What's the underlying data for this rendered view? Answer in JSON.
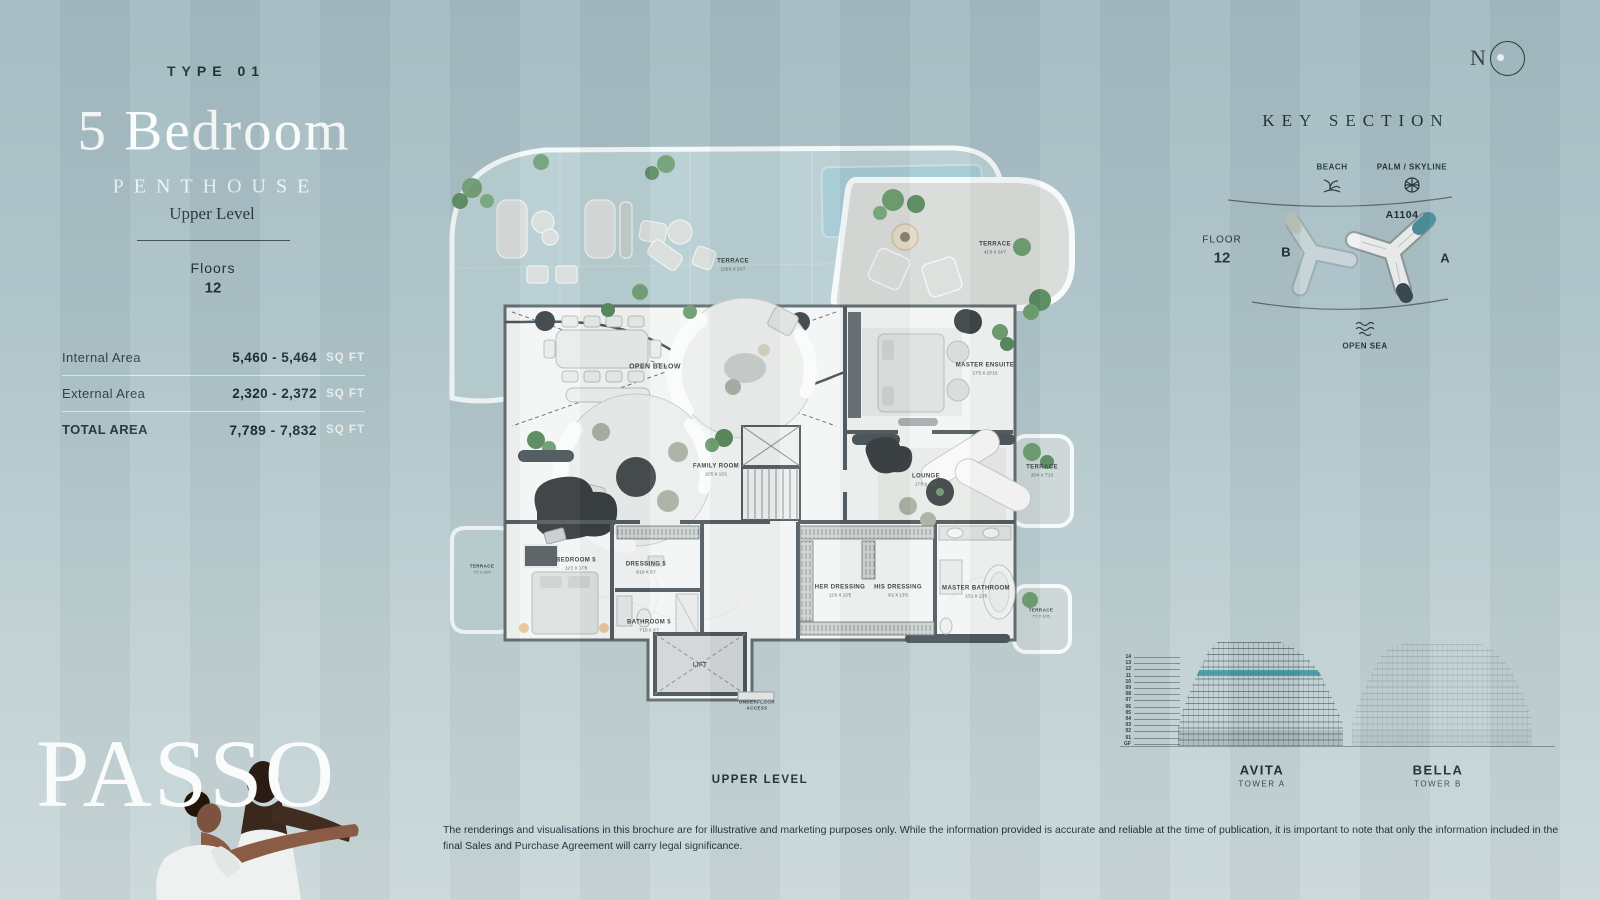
{
  "header": {
    "type_label": "TYPE 01",
    "title": "5 Bedroom",
    "subtitle": "PENTHOUSE",
    "level": "Upper Level",
    "floors_label": "Floors",
    "floors_value": "12"
  },
  "areas": {
    "rows": [
      {
        "label": "Internal Area",
        "value": "5,460 - 5,464",
        "unit": "SQ FT"
      },
      {
        "label": "External Area",
        "value": "2,320 - 2,372",
        "unit": "SQ FT"
      },
      {
        "label": "TOTAL AREA",
        "value": "7,789 - 7,832",
        "unit": "SQ FT"
      }
    ]
  },
  "brand": {
    "logo": "PASSO"
  },
  "compass": {
    "north": "N"
  },
  "plan": {
    "caption": "UPPER LEVEL",
    "labels": {
      "terrace_main": {
        "name": "TERRACE",
        "dims": "126'6 X 24'7"
      },
      "terrace_top_right": {
        "name": "TERRACE",
        "dims": "41'0 X 24'7"
      },
      "open_below": {
        "name": "OPEN BELOW",
        "dims": ""
      },
      "master_ensuite": {
        "name": "MASTER ENSUITE",
        "dims": "17'5 X 23'10"
      },
      "lounge": {
        "name": "LOUNGE",
        "dims": "17'5 X 15'1"
      },
      "terrace_right": {
        "name": "TERRACE",
        "dims": "20'4 X 7'10"
      },
      "family_room": {
        "name": "FAMILY ROOM",
        "dims": "15'5 X 13'1"
      },
      "bedroom5": {
        "name": "BEDROOM 5",
        "dims": "12'2 X 17'8"
      },
      "dressing5": {
        "name": "DRESSING 5",
        "dims": "9'10 X 6'7"
      },
      "bathroom5": {
        "name": "BATHROOM 5",
        "dims": "7'10 X 6'7"
      },
      "her_dressing": {
        "name": "HER DRESSING",
        "dims": "12'6 X 13'5"
      },
      "his_dressing": {
        "name": "HIS DRESSING",
        "dims": "9'2 X 13'5"
      },
      "master_bathroom": {
        "name": "MASTER BATHROOM",
        "dims": "13'1 X 13'5"
      },
      "lift": {
        "name": "LIFT",
        "dims": ""
      },
      "underfloor_access": {
        "name": "UNDERFLOOR ACCESS",
        "dims": ""
      },
      "terrace_left": {
        "name": "TERRACE",
        "dims": "7'2 X 16'5"
      },
      "terrace_bottom_right": {
        "name": "TERRACE",
        "dims": "7'2 X 10'6"
      }
    }
  },
  "key_section": {
    "title": "KEY SECTION",
    "beach_label": "BEACH",
    "palm_label": "PALM / SKYLINE",
    "floor_label": "FLOOR",
    "floor_value": "12",
    "tower_b_letter": "B",
    "tower_a_letter": "A",
    "unit_code": "A1104",
    "open_sea_label": "OPEN SEA"
  },
  "elevations": {
    "floors": [
      "14",
      "13",
      "12",
      "11",
      "10",
      "09",
      "08",
      "07",
      "06",
      "05",
      "04",
      "03",
      "02",
      "01",
      "GF"
    ],
    "tower_a_name": "AVITA",
    "tower_a_sub": "TOWER A",
    "tower_b_name": "BELLA",
    "tower_b_sub": "TOWER B"
  },
  "disclaimer": "The renderings and visualisations in this brochure are for illustrative and marketing purposes only. While the information provided is accurate and reliable at the time of publication, it is important to note that only the information included in the final Sales and Purchase Agreement will carry legal significance.",
  "colors": {
    "accent_teal": "#4e8e9b",
    "pool_teal": "#a6cbd4",
    "background_top": "#a3bbc2",
    "background_bottom": "#cbd8da",
    "wall_dark": "#4e585c",
    "text_dark": "#22343a"
  }
}
